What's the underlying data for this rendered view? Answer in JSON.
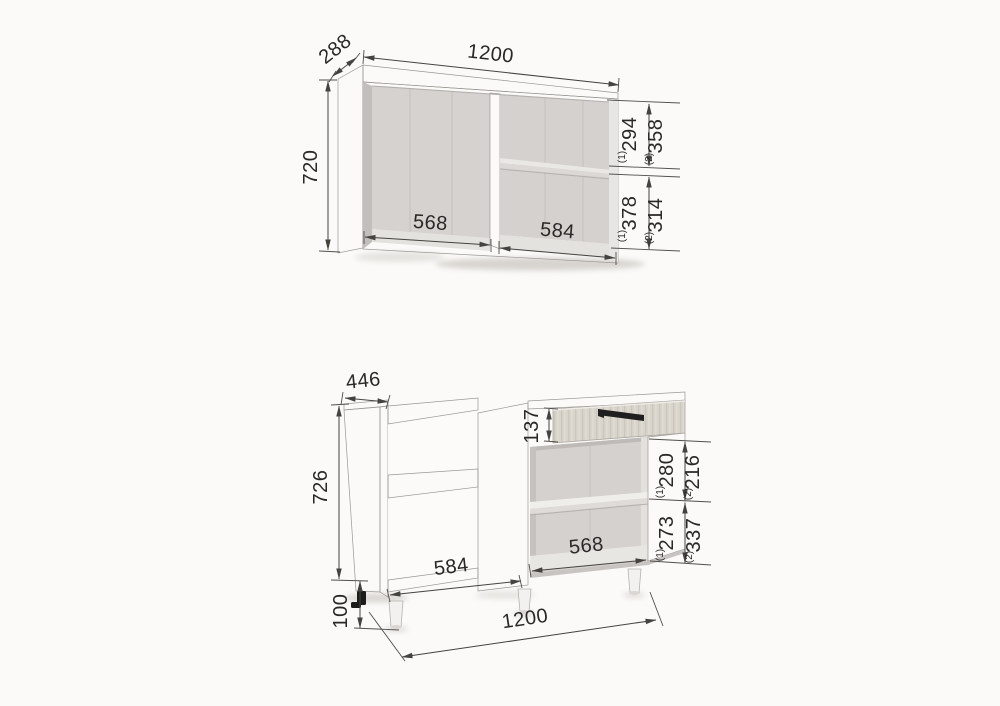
{
  "colors": {
    "background": "#fbfaf8",
    "dimension_line": "#45433f",
    "dimension_text": "#292826",
    "carcass_side": "#cac7c4",
    "carcass_front": "#ccc9c6",
    "interior_back": "#d5d2cf",
    "panel_highlight": "#f4f3f1",
    "drawer_wood": "#d8d4cb",
    "handle_black": "#1f1f1f"
  },
  "wall_cabinet": {
    "width_mm": "1200",
    "height_mm": "720",
    "depth_mm": "288",
    "left_opening_width_mm": "568",
    "right_opening_width_mm": "584",
    "upper_section": {
      "option1_mark": "(1)",
      "option1_value": "294",
      "option2_mark": "(2)",
      "option2_value": "358"
    },
    "lower_section": {
      "option1_mark": "(1)",
      "option1_value": "378",
      "option2_mark": "(2)",
      "option2_value": "314"
    }
  },
  "base_cabinet": {
    "width_mm": "1200",
    "height_mm": "726",
    "depth_mm": "446",
    "legs_height_mm": "100",
    "drawer_front_height_mm": "137",
    "left_opening_width_mm": "584",
    "right_opening_width_mm": "568",
    "upper_section": {
      "option1_mark": "(1)",
      "option1_value": "280",
      "option2_mark": "(2)",
      "option2_value": "216"
    },
    "lower_section": {
      "option1_mark": "(1)",
      "option1_value": "273",
      "option2_mark": "(2)",
      "option2_value": "337"
    }
  }
}
